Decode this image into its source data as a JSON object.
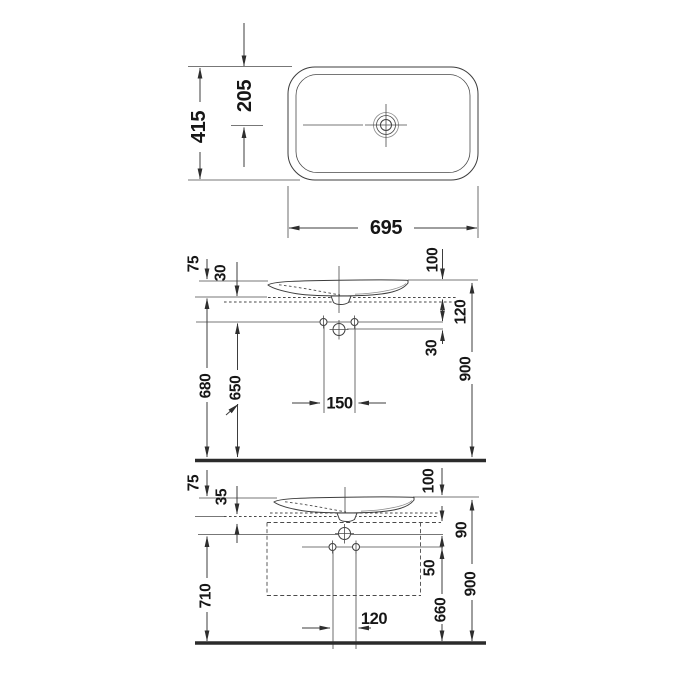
{
  "drawing": {
    "background": "#ffffff",
    "line_color": "#3d3d3d",
    "text_color": "#161616",
    "views": {
      "plan": {
        "width_mm": "695",
        "depth_mm": "415",
        "drain_offset_mm": "205"
      },
      "elevation_wall": {
        "rim_above_deck": "75",
        "deck_inset": "30",
        "basin_height": "100",
        "deck_to_holes": "120",
        "hole_rows_gap": "30",
        "deck_height": "680",
        "drain_height": "650",
        "hole_spacing": "150",
        "rim_height": "900"
      },
      "elevation_furniture": {
        "rim_above_deck": "75",
        "deck_inset": "35",
        "basin_height": "100",
        "deck_to_holes": "90",
        "hole_rows_gap": "50",
        "cabinet_height": "710",
        "hole_spacing": "120",
        "drain_height": "660",
        "rim_height": "900"
      }
    }
  }
}
